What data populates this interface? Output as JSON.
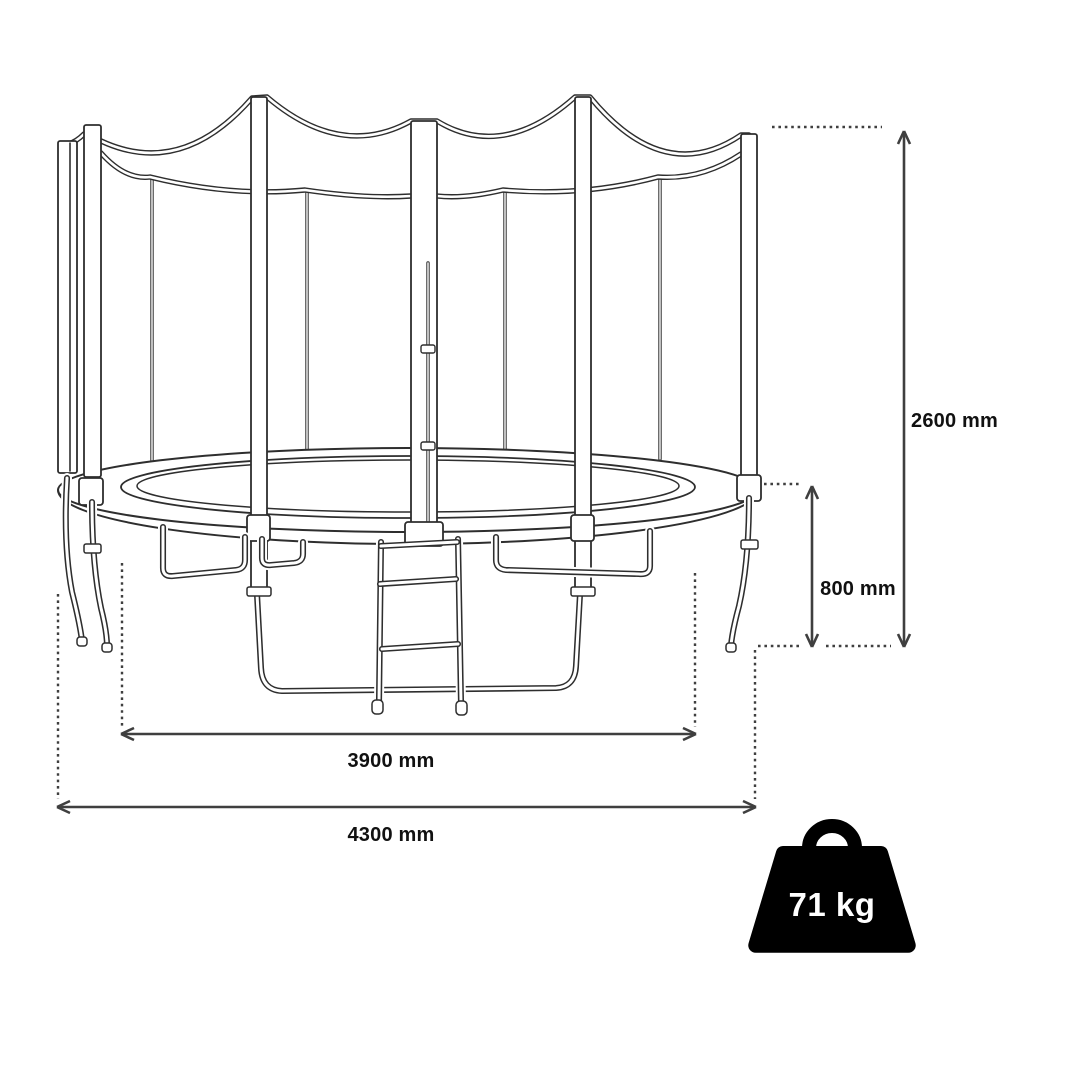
{
  "diagram": {
    "labels": {
      "total_height": "2600 mm",
      "frame_height": "800 mm",
      "inner_diameter": "3900 mm",
      "outer_diameter": "4300 mm",
      "weight": "71 kg"
    },
    "colors": {
      "background": "#ffffff",
      "artwork_line": "#2e2e2e",
      "dimension_line": "#3f3f3f",
      "label_text": "#111111",
      "weight_fill": "#000000",
      "weight_text": "#ffffff"
    }
  }
}
